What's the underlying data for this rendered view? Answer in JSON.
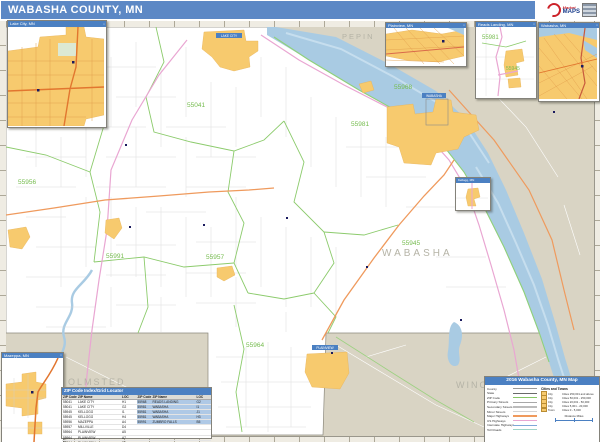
{
  "banner": {
    "title": "WABASHA COUNTY, MN"
  },
  "logo": {
    "word1": "Market",
    "word2": "MAPS"
  },
  "map": {
    "county_labels": [
      {
        "text": "PEPIN"
      },
      {
        "text": "WABASHA"
      },
      {
        "text": "OLMSTED"
      },
      {
        "text": "WINONA"
      }
    ],
    "zip_labels": [
      {
        "text": "55041"
      },
      {
        "text": "55956"
      },
      {
        "text": "55968"
      },
      {
        "text": "55981"
      },
      {
        "text": "55991"
      },
      {
        "text": "55957"
      },
      {
        "text": "55945"
      },
      {
        "text": "55964"
      }
    ],
    "city_labels": [
      {
        "text": "LAKE CITY"
      },
      {
        "text": "WABASHA"
      },
      {
        "text": "PLAINVIEW"
      }
    ]
  },
  "insets": {
    "lake_city": {
      "title": "Lake City, MN"
    },
    "plainview": {
      "title": "Plainview, MN"
    },
    "reads_landing": {
      "title": "Reads Landing, MN",
      "zip_a": "55981",
      "zip_b": "55945"
    },
    "wabasha": {
      "title": "Wabasha, MN"
    },
    "kellogg": {
      "title": "Kellogg, MN"
    },
    "mazeppa": {
      "title": "Mazeppa, MN"
    }
  },
  "zip_table": {
    "title": "ZIP Code Index/Grid Locator",
    "headers": [
      "ZIP Code",
      "ZIP Name",
      "LOC"
    ],
    "left_rows": [
      {
        "zip": "55041",
        "name": "LAKE CITY",
        "loc": "H1"
      },
      {
        "zip": "55041",
        "name": "LAKE CITY",
        "loc": "G2"
      },
      {
        "zip": "55945",
        "name": "KELLOGG",
        "loc": "I1"
      },
      {
        "zip": "55945",
        "name": "KELLOGG",
        "loc": "H4"
      },
      {
        "zip": "55956",
        "name": "MAZEPPA",
        "loc": "A4"
      },
      {
        "zip": "55957",
        "name": "MILLVILLE",
        "loc": "D4"
      },
      {
        "zip": "55964",
        "name": "PLAINVIEW",
        "loc": "A5"
      },
      {
        "zip": "55964",
        "name": "PLAINVIEW",
        "loc": "A7"
      },
      {
        "zip": "55964",
        "name": "PLAINVIEW",
        "loc": "F8"
      }
    ],
    "right_rows": [
      {
        "zip": "55968",
        "name": "READS LANDING",
        "loc": "G2"
      },
      {
        "zip": "55981",
        "name": "WABASHA",
        "loc": "I1"
      },
      {
        "zip": "55981",
        "name": "WABASHA",
        "loc": "J1"
      },
      {
        "zip": "55981",
        "name": "WABASHA",
        "loc": "H3"
      },
      {
        "zip": "55991",
        "name": "ZUMBRO FALLS",
        "loc": "B5"
      }
    ]
  },
  "legend": {
    "title": "2016 Wabasha County, MN Map",
    "layers": [
      {
        "label": "County",
        "color": "#9a9a9a"
      },
      {
        "label": "State",
        "color": "#6a6a6a"
      },
      {
        "label": "ZIP Code",
        "color": "#86C765"
      },
      {
        "label": "Primary Streets",
        "color": "#a8a8a8"
      },
      {
        "label": "Secondary Streets",
        "color": "#bcbcbc"
      },
      {
        "label": "Minor Streets",
        "color": "#d4d4d4"
      },
      {
        "label": "Major Highways",
        "color": "#EF9A5D"
      },
      {
        "label": "US Highways",
        "color": "#E9A6D2"
      },
      {
        "label": "Interstate Highways",
        "color": "#7FA8D8"
      },
      {
        "label": "Toll Roads",
        "color": "#9FD4C8"
      }
    ],
    "cities_header": "Cities and Towns",
    "city_classes": [
      {
        "icon": "City",
        "label": "Cities 250,001 and above"
      },
      {
        "icon": "City",
        "label": "Cities 50,001 - 250,000"
      },
      {
        "icon": "City",
        "label": "Cities 20,001 - 50,000"
      },
      {
        "icon": "City",
        "label": "Cities 5,001 - 20,000"
      },
      {
        "icon": "Town",
        "label": "Cities 0 - 5,000"
      }
    ],
    "scale_label": "Distance Miles"
  },
  "colors": {
    "banner_blue": "#5C88C5",
    "inset_title_blue": "#4B80C2",
    "county_fill": "#FFFFFF",
    "neighbor_fill": "#D9D4C4",
    "water": "#A9CBE3",
    "city_fill": "#F7CA6E",
    "zip_label_green": "#76BC4F",
    "zip_boundary_green": "#8CCB6C",
    "major_highway_orange": "#EF9A5D",
    "us_highway_pink": "#E9A6D2",
    "county_label_gray": "#B5B3A6",
    "logo_red": "#CC2229",
    "logo_blue": "#1B3E8C"
  }
}
